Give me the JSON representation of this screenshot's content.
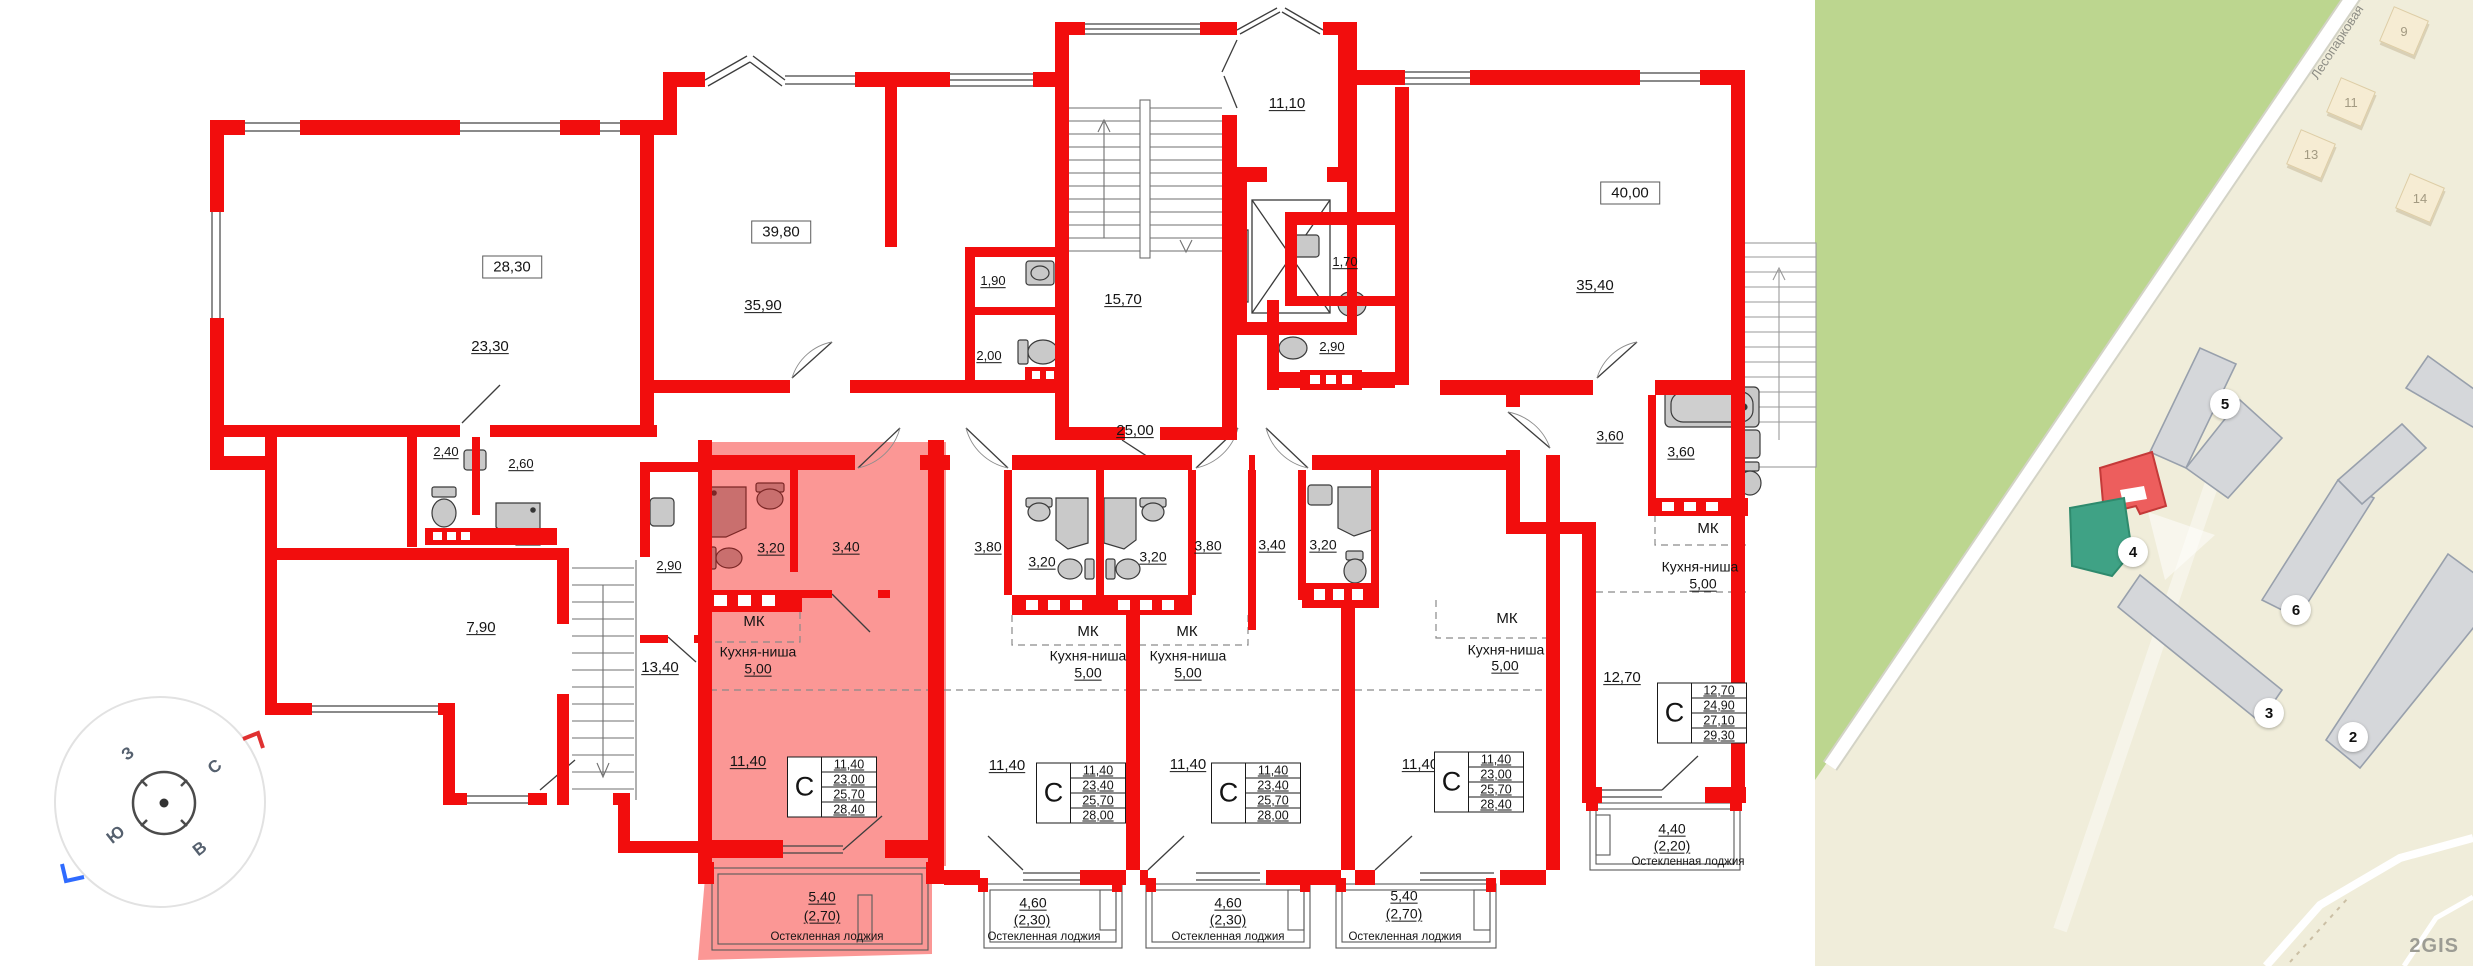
{
  "colors": {
    "wall_red": "#f20d0d",
    "highlight_pink": "#fb9795",
    "map_green": "#bcd68f",
    "map_beige": "#f0edda",
    "selected_building_red": "#ed5e5d",
    "entrance_building_green": "#3fa285"
  },
  "plan": {
    "apartment_totals": [
      {
        "n": "total-area-28-30",
        "t": "28,30",
        "x": 512,
        "y": 267
      },
      {
        "n": "total-area-39-80",
        "t": "39,80",
        "x": 781,
        "y": 232
      },
      {
        "n": "total-area-40-00",
        "t": "40,00",
        "x": 1630,
        "y": 193
      }
    ],
    "labels": [
      {
        "n": "room-23-30",
        "t": "23,30",
        "x": 490,
        "y": 347,
        "fs": 15,
        "u": 1
      },
      {
        "n": "room-35-90",
        "t": "35,90",
        "x": 763,
        "y": 306,
        "fs": 15,
        "u": 1
      },
      {
        "n": "room-1-90",
        "t": "1,90",
        "x": 993,
        "y": 281,
        "fs": 13,
        "u": 1
      },
      {
        "n": "room-2-00",
        "t": "2,00",
        "x": 989,
        "y": 356,
        "fs": 13,
        "u": 1
      },
      {
        "n": "room-15-70",
        "t": "15,70",
        "x": 1123,
        "y": 300,
        "fs": 15,
        "u": 1
      },
      {
        "n": "room-11-10",
        "t": "11,10",
        "x": 1287,
        "y": 104,
        "fs": 15,
        "u": 1
      },
      {
        "n": "room-1-70",
        "t": "1,70",
        "x": 1345,
        "y": 262,
        "fs": 13,
        "u": 1
      },
      {
        "n": "room-2-90-right",
        "t": "2,90",
        "x": 1332,
        "y": 347,
        "fs": 13,
        "u": 1
      },
      {
        "n": "corridor-25-00",
        "t": "25,00",
        "x": 1135,
        "y": 431,
        "fs": 15,
        "u": 1
      },
      {
        "n": "room-2-40",
        "t": "2,40",
        "x": 446,
        "y": 452,
        "fs": 13,
        "u": 1
      },
      {
        "n": "room-2-60",
        "t": "2,60",
        "x": 521,
        "y": 464,
        "fs": 13,
        "u": 1
      },
      {
        "n": "room-2-90-left",
        "t": "2,90",
        "x": 669,
        "y": 566,
        "fs": 13,
        "u": 1
      },
      {
        "n": "room-7-90",
        "t": "7,90",
        "x": 481,
        "y": 628,
        "fs": 15,
        "u": 1
      },
      {
        "n": "room-13-40",
        "t": "13,40",
        "x": 660,
        "y": 668,
        "fs": 15,
        "u": 1
      },
      {
        "n": "room-35-40",
        "t": "35,40",
        "x": 1595,
        "y": 286,
        "fs": 15,
        "u": 1
      },
      {
        "n": "room-3-60-a",
        "t": "3,60",
        "x": 1610,
        "y": 436,
        "fs": 14,
        "u": 1
      },
      {
        "n": "room-3-60-b",
        "t": "3,60",
        "x": 1681,
        "y": 452,
        "fs": 14,
        "u": 1
      },
      {
        "n": "room-3-20-pink",
        "t": "3,20",
        "x": 771,
        "y": 548,
        "fs": 14,
        "u": 1
      },
      {
        "n": "room-3-40-pink",
        "t": "3,40",
        "x": 846,
        "y": 547,
        "fs": 14,
        "u": 1
      },
      {
        "n": "room-3-80-u2",
        "t": "3,80",
        "x": 988,
        "y": 547,
        "fs": 14,
        "u": 1
      },
      {
        "n": "room-3-20-u2",
        "t": "3,20",
        "x": 1042,
        "y": 562,
        "fs": 14,
        "u": 1
      },
      {
        "n": "room-3-20-u3",
        "t": "3,20",
        "x": 1153,
        "y": 557,
        "fs": 14,
        "u": 1
      },
      {
        "n": "room-3-80-u3",
        "t": "3,80",
        "x": 1208,
        "y": 546,
        "fs": 14,
        "u": 1
      },
      {
        "n": "room-3-40-u4",
        "t": "3,40",
        "x": 1272,
        "y": 545,
        "fs": 14,
        "u": 1
      },
      {
        "n": "room-3-20-u4",
        "t": "3,20",
        "x": 1323,
        "y": 545,
        "fs": 14,
        "u": 1
      },
      {
        "n": "room-12-70",
        "t": "12,70",
        "x": 1622,
        "y": 678,
        "fs": 15,
        "u": 1
      },
      {
        "n": "room-11-40-pink",
        "t": "11,40",
        "x": 748,
        "y": 762,
        "fs": 15,
        "u": 1
      },
      {
        "n": "room-11-40-u2",
        "t": "11,40",
        "x": 1007,
        "y": 766,
        "fs": 15,
        "u": 1
      },
      {
        "n": "room-11-40-u3",
        "t": "11,40",
        "x": 1188,
        "y": 765,
        "fs": 15,
        "u": 1
      },
      {
        "n": "room-11-40-u4",
        "t": "11,40",
        "x": 1420,
        "y": 765,
        "fs": 15,
        "u": 1
      },
      {
        "n": "mk-pink",
        "t": "МК",
        "x": 754,
        "y": 622,
        "fs": 15,
        "u": 0
      },
      {
        "n": "mk-u2",
        "t": "МК",
        "x": 1088,
        "y": 632,
        "fs": 15,
        "u": 0
      },
      {
        "n": "mk-u3",
        "t": "МК",
        "x": 1187,
        "y": 632,
        "fs": 15,
        "u": 0
      },
      {
        "n": "mk-u4",
        "t": "МК",
        "x": 1507,
        "y": 619,
        "fs": 15,
        "u": 0
      },
      {
        "n": "mk-u5",
        "t": "МК",
        "x": 1708,
        "y": 529,
        "fs": 15,
        "u": 0
      },
      {
        "n": "kitchen-pink",
        "t": "Кухня-ниша",
        "x": 758,
        "y": 652,
        "fs": 14,
        "u": 0
      },
      {
        "n": "kitchen-pink-area",
        "t": "5,00",
        "x": 758,
        "y": 669,
        "fs": 14,
        "u": 1
      },
      {
        "n": "kitchen-u2",
        "t": "Кухня-ниша",
        "x": 1088,
        "y": 656,
        "fs": 14,
        "u": 0
      },
      {
        "n": "kitchen-u2-area",
        "t": "5,00",
        "x": 1088,
        "y": 673,
        "fs": 14,
        "u": 1
      },
      {
        "n": "kitchen-u3",
        "t": "Кухня-ниша",
        "x": 1188,
        "y": 656,
        "fs": 14,
        "u": 0
      },
      {
        "n": "kitchen-u3-area",
        "t": "5,00",
        "x": 1188,
        "y": 673,
        "fs": 14,
        "u": 1
      },
      {
        "n": "kitchen-u4",
        "t": "Кухня-ниша",
        "x": 1506,
        "y": 650,
        "fs": 14,
        "u": 0
      },
      {
        "n": "kitchen-u4-area",
        "t": "5,00",
        "x": 1505,
        "y": 666,
        "fs": 14,
        "u": 1
      },
      {
        "n": "kitchen-u5",
        "t": "Кухня-ниша",
        "x": 1700,
        "y": 567,
        "fs": 14,
        "u": 0
      },
      {
        "n": "kitchen-u5-area",
        "t": "5,00",
        "x": 1703,
        "y": 584,
        "fs": 14,
        "u": 1
      },
      {
        "n": "loggia-pink-a",
        "t": "5,40",
        "x": 822,
        "y": 897,
        "fs": 14,
        "u": 1
      },
      {
        "n": "loggia-pink-b",
        "t": "(2,70)",
        "x": 822,
        "y": 916,
        "fs": 14,
        "u": 1
      },
      {
        "n": "loggia-u2-a",
        "t": "4,60",
        "x": 1033,
        "y": 903,
        "fs": 14,
        "u": 1
      },
      {
        "n": "loggia-u2-b",
        "t": "(2,30)",
        "x": 1032,
        "y": 920,
        "fs": 14,
        "u": 1
      },
      {
        "n": "loggia-u3-a",
        "t": "4,60",
        "x": 1228,
        "y": 903,
        "fs": 14,
        "u": 1
      },
      {
        "n": "loggia-u3-b",
        "t": "(2,30)",
        "x": 1228,
        "y": 920,
        "fs": 14,
        "u": 1
      },
      {
        "n": "loggia-u4-a",
        "t": "5,40",
        "x": 1404,
        "y": 896,
        "fs": 14,
        "u": 1
      },
      {
        "n": "loggia-u4-b",
        "t": "(2,70)",
        "x": 1404,
        "y": 914,
        "fs": 14,
        "u": 1
      },
      {
        "n": "loggia-u5-a",
        "t": "4,40",
        "x": 1672,
        "y": 829,
        "fs": 14,
        "u": 1
      },
      {
        "n": "loggia-u5-b",
        "t": "(2,20)",
        "x": 1672,
        "y": 846,
        "fs": 14,
        "u": 1
      },
      {
        "n": "loggia-caption-pink",
        "t": "Остекленная лоджия",
        "x": 827,
        "y": 937,
        "fs": 11.5,
        "u": 0
      },
      {
        "n": "loggia-caption-u2",
        "t": "Остекленная лоджия",
        "x": 1044,
        "y": 937,
        "fs": 11.5,
        "u": 0
      },
      {
        "n": "loggia-caption-u3",
        "t": "Остекленная лоджия",
        "x": 1228,
        "y": 937,
        "fs": 11.5,
        "u": 0
      },
      {
        "n": "loggia-caption-u4",
        "t": "Остекленная лоджия",
        "x": 1405,
        "y": 937,
        "fs": 11.5,
        "u": 0
      },
      {
        "n": "loggia-caption-u5",
        "t": "Остекленная лоджия",
        "x": 1688,
        "y": 862,
        "fs": 11.5,
        "u": 0
      }
    ],
    "unit_tables": [
      {
        "n": "studio-table-pink",
        "letter": "С",
        "rows": [
          "11,40",
          "23,00",
          "25,70",
          "28,40"
        ],
        "x": 832,
        "y": 787
      },
      {
        "n": "studio-table-u2",
        "letter": "С",
        "rows": [
          "11,40",
          "23,40",
          "25,70",
          "28,00"
        ],
        "x": 1081,
        "y": 793
      },
      {
        "n": "studio-table-u3",
        "letter": "С",
        "rows": [
          "11,40",
          "23,40",
          "25,70",
          "28,00"
        ],
        "x": 1256,
        "y": 793
      },
      {
        "n": "studio-table-u4",
        "letter": "С",
        "rows": [
          "11,40",
          "23,00",
          "25,70",
          "28,40"
        ],
        "x": 1479,
        "y": 782
      },
      {
        "n": "studio-table-u5",
        "letter": "С",
        "rows": [
          "12,70",
          "24,90",
          "27,10",
          "29,30"
        ],
        "x": 1702,
        "y": 713
      }
    ]
  },
  "compass": {
    "letters": [
      {
        "n": "compass-west",
        "t": "З",
        "x": 128,
        "y": 754
      },
      {
        "n": "compass-north",
        "t": "С",
        "x": 215,
        "y": 767
      },
      {
        "n": "compass-south",
        "t": "Ю",
        "x": 116,
        "y": 835
      },
      {
        "n": "compass-east",
        "t": "В",
        "x": 200,
        "y": 849
      }
    ]
  },
  "map": {
    "street_label": "Лесопарковая",
    "watermark": "2GIS",
    "house_numbers": [
      {
        "n": "map-house-9",
        "t": "9",
        "x": 2404,
        "y": 31
      },
      {
        "n": "map-house-11",
        "t": "11",
        "x": 2351,
        "y": 102
      },
      {
        "n": "map-house-13",
        "t": "13",
        "x": 2311,
        "y": 154
      },
      {
        "n": "map-house-14",
        "t": "14",
        "x": 2420,
        "y": 198
      }
    ],
    "building_badges": [
      {
        "n": "map-badge-5",
        "t": "5",
        "x": 2225,
        "y": 404
      },
      {
        "n": "map-badge-4",
        "t": "4",
        "x": 2133,
        "y": 552
      },
      {
        "n": "map-badge-6",
        "t": "6",
        "x": 2296,
        "y": 610
      },
      {
        "n": "map-badge-3",
        "t": "3",
        "x": 2269,
        "y": 713
      },
      {
        "n": "map-badge-2",
        "t": "2",
        "x": 2353,
        "y": 737
      }
    ]
  }
}
